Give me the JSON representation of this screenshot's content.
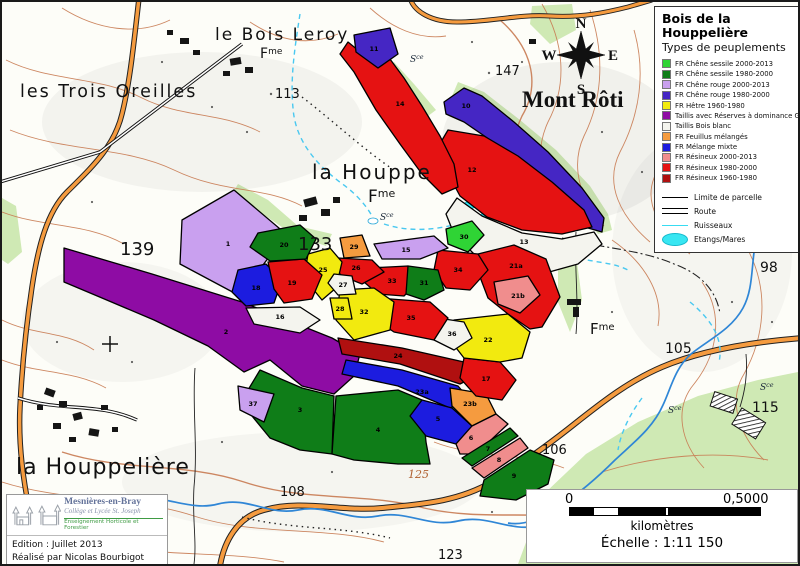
{
  "legend": {
    "title": "Bois de la Houppelière",
    "subtitle": "Types de peuplements",
    "items": [
      {
        "label": "FR Chêne sessile 2000-2013",
        "color": "#2fd435"
      },
      {
        "label": "FR Chêne sessile 1980-2000",
        "color": "#0f7d18"
      },
      {
        "label": "FR Chêne rouge 2000-2013",
        "color": "#c9a0ef"
      },
      {
        "label": "FR Chêne rouge 1980-2000",
        "color": "#4526c4"
      },
      {
        "label": "FR Hêtre 1960-1980",
        "color": "#f2ea0f"
      },
      {
        "label": "Taillis avec Réserves à dominance GB",
        "color": "#8e0ca4"
      },
      {
        "label": "Taillis Bois blanc",
        "color": "#f4f4ee"
      },
      {
        "label": "FR Feuillus mélangés",
        "color": "#f59b3f"
      },
      {
        "label": "FR Mélange mixte",
        "color": "#1c1cdf"
      },
      {
        "label": "FR Résineux 2000-2013",
        "color": "#f08d8d"
      },
      {
        "label": "FR Résineux 1980-2000",
        "color": "#e51212"
      },
      {
        "label": "FR Résineux 1960-1980",
        "color": "#b01010"
      }
    ],
    "symbols": [
      {
        "label": "Limite de parcelle"
      },
      {
        "label": "Route"
      },
      {
        "label": "Ruisseaux"
      },
      {
        "label": "Etangs/Mares"
      }
    ]
  },
  "colors": {
    "cs2000": "#2fd435",
    "cs1980": "#0f7d18",
    "cr2000": "#c9a0ef",
    "cr1980": "#4526c4",
    "hetre": "#f2ea0f",
    "taillis_gb": "#8e0ca4",
    "taillis_bb": "#f4f4ee",
    "feuillus": "#f59b3f",
    "melange": "#1c1cdf",
    "res2000": "#f08d8d",
    "res1980": "#e51212",
    "res1960": "#b01010"
  },
  "parcels": {
    "1": {
      "id": "1",
      "type": "cr2000"
    },
    "2": {
      "id": "2",
      "type": "taillis_gb"
    },
    "3": {
      "id": "3",
      "type": "cs1980"
    },
    "4": {
      "id": "4",
      "type": "cs1980"
    },
    "5": {
      "id": "5",
      "type": "melange"
    },
    "6": {
      "id": "6",
      "type": "res2000"
    },
    "7": {
      "id": "7",
      "type": "cs1980"
    },
    "8": {
      "id": "8",
      "type": "res2000"
    },
    "9": {
      "id": "9",
      "type": "cs1980"
    },
    "10": {
      "id": "10",
      "type": "cr1980"
    },
    "11": {
      "id": "11",
      "type": "cr1980"
    },
    "12": {
      "id": "12",
      "type": "res1980"
    },
    "13": {
      "id": "13",
      "type": "taillis_bb"
    },
    "14": {
      "id": "14",
      "type": "res1980"
    },
    "15": {
      "id": "15",
      "type": "cr2000"
    },
    "16": {
      "id": "16",
      "type": "taillis_bb"
    },
    "17": {
      "id": "17",
      "type": "res1980"
    },
    "18": {
      "id": "18",
      "type": "melange"
    },
    "19": {
      "id": "19",
      "type": "res1980"
    },
    "20": {
      "id": "20",
      "type": "cs1980"
    },
    "21a": {
      "id": "21a",
      "type": "res1980"
    },
    "21b": {
      "id": "21b",
      "type": "res2000"
    },
    "22": {
      "id": "22",
      "type": "hetre"
    },
    "23a": {
      "id": "23a",
      "type": "melange"
    },
    "23b": {
      "id": "23b",
      "type": "feuillus"
    },
    "24": {
      "id": "24",
      "type": "res1960"
    },
    "25": {
      "id": "25",
      "type": "hetre"
    },
    "26": {
      "id": "26",
      "type": "res1980"
    },
    "27": {
      "id": "27",
      "type": "taillis_bb"
    },
    "28": {
      "id": "28",
      "type": "hetre"
    },
    "29": {
      "id": "29",
      "type": "feuillus"
    },
    "30": {
      "id": "30",
      "type": "cs2000"
    },
    "31": {
      "id": "31",
      "type": "cs1980"
    },
    "32": {
      "id": "32",
      "type": "hetre"
    },
    "33": {
      "id": "33",
      "type": "res1980"
    },
    "34": {
      "id": "34",
      "type": "res1980"
    },
    "35": {
      "id": "35",
      "type": "res1980"
    },
    "36": {
      "id": "36",
      "type": "taillis_bb"
    },
    "37": {
      "id": "37",
      "type": "cr2000"
    }
  },
  "labels": {
    "trois_oreilles": "les Trois Oreilles",
    "bois_leroy": "le Bois Leroy",
    "la_houppe": "la Houppe",
    "mont_roti": "Mont Rôti",
    "la_houppeliere": "la Houppelière",
    "fme_base": "F",
    "fme_sup": "me",
    "sce_base": "S",
    "sce_sup": "ce",
    "s147": "147",
    "s139": "139",
    "s133": "133",
    "s113": "113",
    "s98": "98",
    "s105": "105",
    "s115": "115",
    "s106": "106",
    "s108": "108",
    "s123": "123",
    "s125": "125"
  },
  "compass": {
    "n": "N",
    "e": "E",
    "s": "S",
    "w": "W"
  },
  "scale": {
    "start": "0",
    "end": "0,5000",
    "units": "kilomètres",
    "ratio": "Échelle : 1:11 150"
  },
  "credits": {
    "name": "Mesnières-en-Bray",
    "school": "Collège et Lycée St. Joseph",
    "tagline": "Enseignement Horticole et Forestier",
    "edition": "Edition : Juillet 2013",
    "author": "Réalisé par Nicolas Bourbigot"
  }
}
